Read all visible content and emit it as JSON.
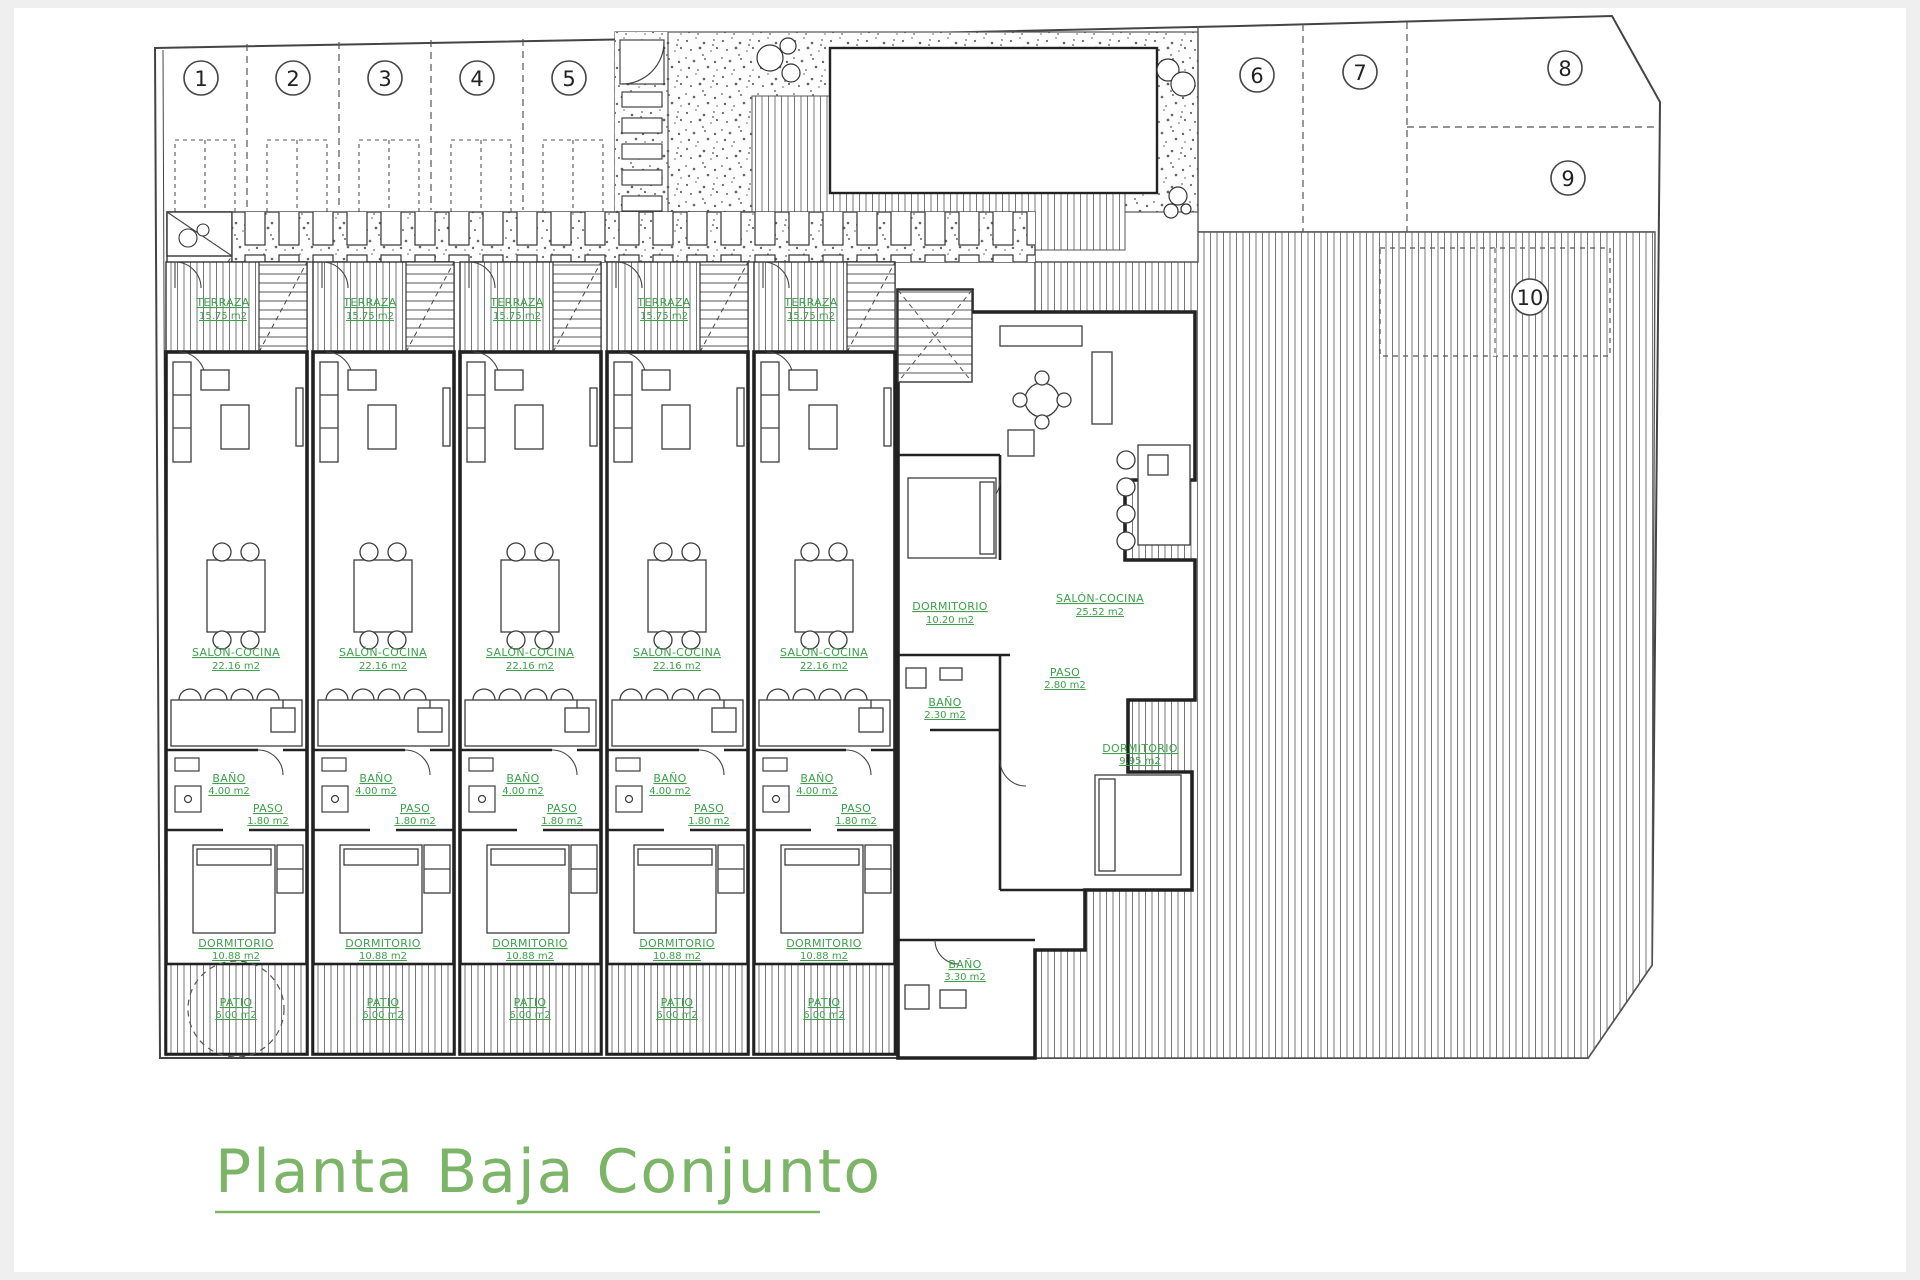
{
  "page": {
    "title": "Planta Baja Conjunto"
  },
  "plots": {
    "p1": "1",
    "p2": "2",
    "p3": "3",
    "p4": "4",
    "p5": "5",
    "p6": "6",
    "p7": "7",
    "p8": "8",
    "p9": "9",
    "p10": "10"
  },
  "rooms": {
    "terraza": {
      "name": "TERRAZA",
      "area": "15.75 m2"
    },
    "salon": {
      "name": "SALÓN-COCINA",
      "area": "22.16 m2"
    },
    "bano": {
      "name": "BAÑO",
      "area": "4.00 m2"
    },
    "paso": {
      "name": "PASO",
      "area": "1.80 m2"
    },
    "dormitorio": {
      "name": "DORMITORIO",
      "area": "10.88 m2"
    },
    "patio": {
      "name": "PATIO",
      "area": "6.00 m2"
    }
  },
  "unit6": {
    "salon": {
      "name": "SALÓN-COCINA",
      "area": "25.52 m2"
    },
    "dormitorio1": {
      "name": "DORMITORIO",
      "area": "10.20 m2"
    },
    "paso": {
      "name": "PASO",
      "area": "2.80 m2"
    },
    "bano1": {
      "name": "BAÑO",
      "area": "2.30 m2"
    },
    "dormitorio2": {
      "name": "DORMITORIO",
      "area": "9.95 m2"
    },
    "bano2": {
      "name": "BAÑO",
      "area": "3.30 m2"
    }
  },
  "colors": {
    "label_green": "#3da04b",
    "title_green": "#7cb567",
    "line_dark": "#2e2e2e"
  }
}
